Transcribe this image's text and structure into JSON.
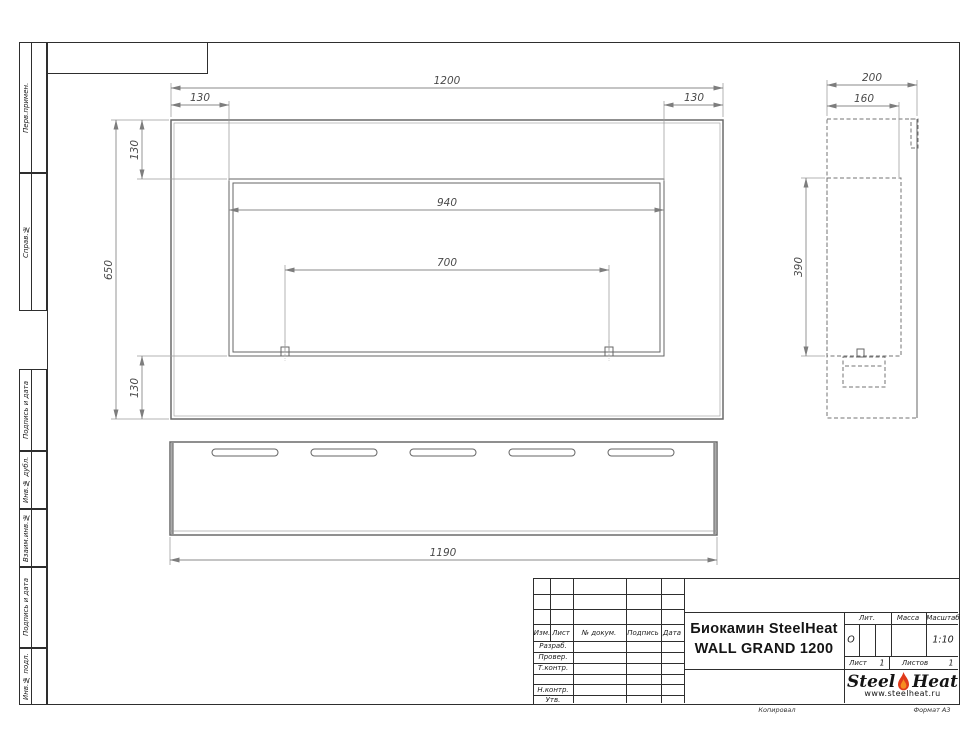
{
  "dims": {
    "front": {
      "width": "1200",
      "offset_left": "130",
      "offset_right": "130",
      "height": "650",
      "offset_top": "130",
      "offset_bottom": "130",
      "opening_width": "940",
      "burner_span": "700"
    },
    "side": {
      "depth": "200",
      "inner_depth": "160",
      "opening_height": "390"
    },
    "bottom": {
      "length": "1190"
    }
  },
  "frame": {
    "side_labels": [
      "Перв.примен.",
      "Справ.№",
      "Подпись и дата",
      "Инв.№ дубл.",
      "Взаим.инв.№",
      "Подпись и дата",
      "Инв.№ подл."
    ],
    "footer_copy": "Копировал",
    "footer_format": "Формат А3"
  },
  "title_block": {
    "rev_headers": {
      "izm": "Изм.",
      "list": "Лист",
      "doc": "№ докум.",
      "sign": "Подпись",
      "date": "Дата"
    },
    "rows": {
      "razrab": "Разраб.",
      "prover": "Провер.",
      "tkontr": "Т.контр.",
      "nkontr": "Н.контр.",
      "utv": "Утв."
    },
    "title_line1": "Биокамин SteelHeat",
    "title_line2": "WALL GRAND 1200",
    "lit_label": "Лит.",
    "lit_value": "О",
    "mass_label": "Масса",
    "scale_label": "Масштаб",
    "scale_value": "1:10",
    "sheet_label": "Лист",
    "sheet_value": "1",
    "sheets_label": "Листов",
    "sheets_value": "1",
    "logo_steel": "Steel",
    "logo_heat": "Heat",
    "logo_url": "www.steelheat.ru"
  },
  "colors": {
    "flame_outer": "#e03a1a",
    "flame_inner": "#f68b1f",
    "object_line": "#6a6a6a",
    "frame_line": "#2e2e2e"
  }
}
